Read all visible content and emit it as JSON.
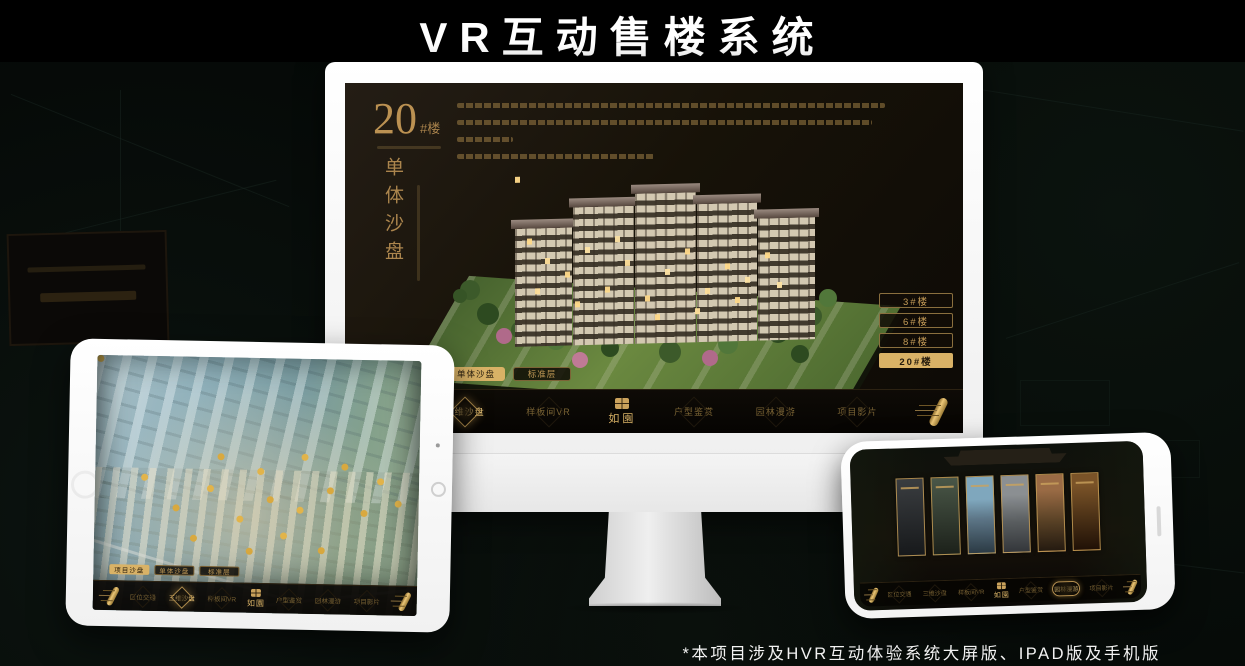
{
  "page": {
    "title": "VR互动售楼系统",
    "footnote": "*本项目涉及HVR互动体验系统大屏版、IPAD版及手机版"
  },
  "colors": {
    "accent_gold": "#d9b266",
    "gold_text": "#c59c57",
    "screen_background": "#171208",
    "page_background": "#050907",
    "title_color": "#ffffff"
  },
  "icons": {
    "scroll": "scroll-handle-icon",
    "seal": "project-seal-icon",
    "home": "tablet-home-button"
  },
  "sales_app": {
    "project_logo": "如園",
    "nav_items": [
      {
        "label": "区位交通"
      },
      {
        "label": "三维沙盘"
      },
      {
        "label": "样板间VR"
      },
      {
        "label": "户型鉴赏"
      },
      {
        "label": "园林漫游"
      },
      {
        "label": "项目影片"
      }
    ],
    "sub_tabs": [
      {
        "label": "项目沙盘"
      },
      {
        "label": "单体沙盘"
      },
      {
        "label": "标准层"
      }
    ]
  },
  "monitor": {
    "headline_number": "20",
    "headline_suffix": "#楼",
    "headline_caption": "单体沙盘",
    "active_sub_tab": "单体沙盘",
    "active_nav_item": "三维沙盘",
    "floor_buttons": [
      {
        "label": "3#楼",
        "active": false
      },
      {
        "label": "6#楼",
        "active": false
      },
      {
        "label": "8#楼",
        "active": false
      },
      {
        "label": "20#楼",
        "active": true
      }
    ]
  },
  "tablet": {
    "active_sub_tab": "项目沙盘",
    "active_nav_item": "三维沙盘"
  },
  "phone": {
    "active_nav_item": "园林漫游",
    "gallery_panel_count": 6
  }
}
